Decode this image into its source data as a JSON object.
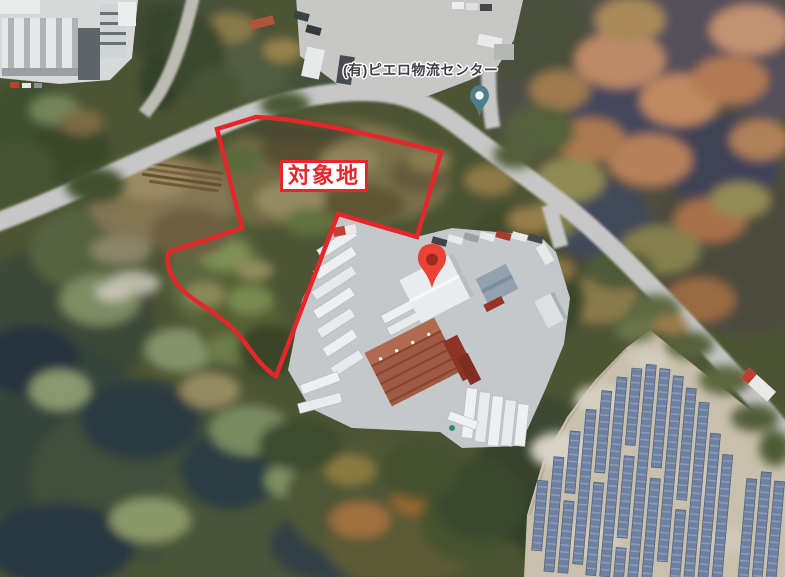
{
  "annotations": {
    "site_label": "対象地",
    "place_label": "(有)ピエロ物流センター"
  },
  "icons": {
    "site_marker": "red-map-pin-icon",
    "place_pin": "teal-place-pin-icon"
  },
  "colors": {
    "site_outline": "#E5262B",
    "site_label_text": "#E5262B",
    "site_label_bg": "#FFFFFF",
    "site_marker": "#EA4335",
    "site_marker_core": "#9E2B1E",
    "place_pin": "#4C7F89",
    "place_pin_hole": "#F3F6F5",
    "place_label_text": "#413E48"
  }
}
